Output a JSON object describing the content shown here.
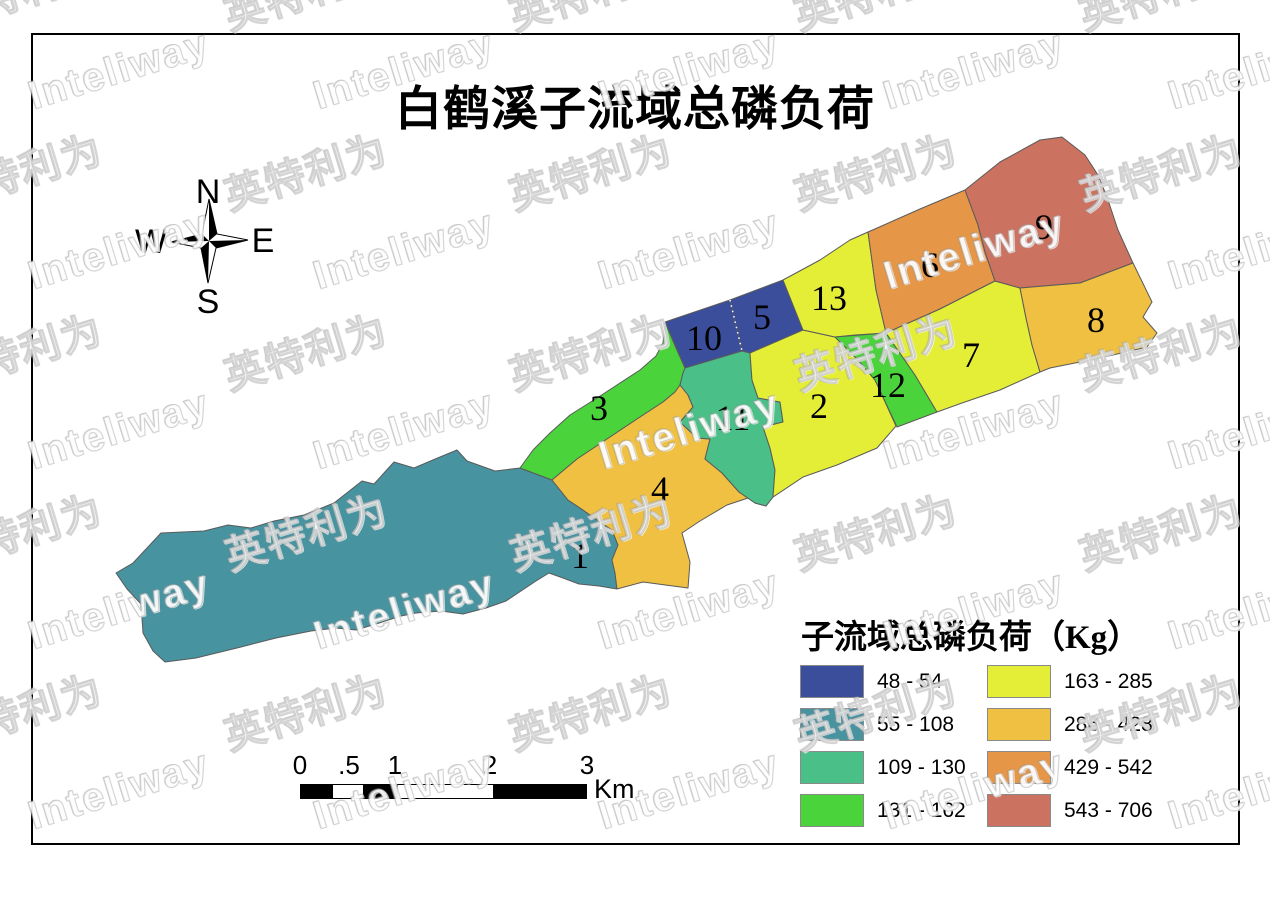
{
  "title": "白鹤溪子流域总磷负荷",
  "compass": {
    "n": "N",
    "e": "E",
    "s": "S",
    "w": "W"
  },
  "scalebar": {
    "ticks": [
      "0",
      ".5",
      "1",
      "2",
      "3"
    ],
    "unit": "Km"
  },
  "legend": {
    "title": "子流域总磷负荷（Kg）",
    "items": [
      {
        "range": "48 - 54",
        "color": "#3b4e9c"
      },
      {
        "range": "55 - 108",
        "color": "#4793a0"
      },
      {
        "range": "109 - 130",
        "color": "#4abf88"
      },
      {
        "range": "131 - 162",
        "color": "#4ad33b"
      },
      {
        "range": "163 - 285",
        "color": "#e4ee37"
      },
      {
        "range": "286 - 428",
        "color": "#efc042"
      },
      {
        "range": "429 - 542",
        "color": "#e59647"
      },
      {
        "range": "543 - 706",
        "color": "#cb7260"
      }
    ]
  },
  "watermark": {
    "latin": "Inteliway",
    "cjk": "英特利为"
  },
  "map": {
    "subbasins": [
      {
        "id": "1",
        "range": "55 - 108",
        "color": "#4793a0",
        "label": [
          580,
          556
        ],
        "points": "457,450 440,457 414,468 394,462 374,484 362,481 334,503 304,515 274,521 251,528 228,525 204,531 161,533 133,563 116,573 127,589 141,604 143,633 153,651 165,662 196,658 241,647 276,638 311,631 336,628 356,630 376,624 401,616 416,613 441,611 463,614 486,608 506,601 521,591 536,581 549,573 563,578 579,584 599,586 617,589 615,573 612,560 618,545 612,530 600,522 583,510 568,500 552,480 520,468 495,471 467,461"
      },
      {
        "id": "3",
        "range": "131 - 162",
        "color": "#4ad33b",
        "label": [
          599,
          408
        ],
        "points": "520,468 533,450 550,433 570,415 597,398 620,383 640,370 656,356 663,343 665,322 676,348 685,368 683,373 680,385 675,392 663,402 637,419 607,439 577,459 552,480"
      },
      {
        "id": "4",
        "range": "286 - 428",
        "color": "#efc042",
        "label": [
          660,
          489
        ],
        "points": "552,480 577,459 607,439 637,419 663,402 675,392 680,385 688,395 693,407 680,422 697,438 710,439 705,459 722,473 739,492 755,503 766,506 773,497 803,477 760,494 727,505 700,521 682,533 690,562 688,588 643,582 617,589 615,573 612,560 618,545 612,530 600,522 583,510 568,500"
      },
      {
        "id": "10",
        "range": "48 - 54",
        "color": "#3b4e9c",
        "label": [
          704,
          338
        ],
        "points": "665,322 730,300 742,351 685,368"
      },
      {
        "id": "5",
        "range": "48 - 54",
        "color": "#3b4e9c",
        "label": [
          762,
          317
        ],
        "points": "730,300 783,280 793,305 803,330 750,353 742,351"
      },
      {
        "id": "11",
        "range": "109 - 130",
        "color": "#4abf88",
        "label": [
          733,
          418
        ],
        "points": "680,385 683,373 685,368 742,351 750,353 752,380 758,398 780,402 783,422 763,427 770,448 775,470 773,497 766,506 755,503 739,492 722,473 705,459 710,439 697,438 680,422 693,407 688,395"
      },
      {
        "id": "2",
        "range": "163 - 285",
        "color": "#e4ee37",
        "label": [
          819,
          406
        ],
        "points": "750,353 803,330 835,337 858,360 875,380 896,426 877,448 837,465 803,477 773,497 775,470 770,448 763,427 783,422 780,402 758,398 752,380"
      },
      {
        "id": "13",
        "range": "163 - 285",
        "color": "#e4ee37",
        "label": [
          829,
          298
        ],
        "points": "783,280 820,260 850,240 868,232 876,290 886,333 855,335 835,337 803,330 793,305"
      },
      {
        "id": "12",
        "range": "131 - 162",
        "color": "#4ad33b",
        "label": [
          888,
          385
        ],
        "points": "835,337 886,333 915,375 937,412 897,427 875,380 858,360"
      },
      {
        "id": "6",
        "range": "429 - 542",
        "color": "#e59647",
        "label": [
          930,
          265
        ],
        "points": "868,232 920,209 965,190 978,225 985,252 995,281 940,309 886,333 876,290"
      },
      {
        "id": "7",
        "range": "163 - 285",
        "color": "#e4ee37",
        "label": [
          971,
          355
        ],
        "points": "886,333 940,309 995,281 1020,288 1026,318 1032,345 1040,372 1000,390 962,403 937,412 915,375"
      },
      {
        "id": "9",
        "range": "543 - 706",
        "color": "#cb7260",
        "label": [
          1044,
          227
        ],
        "points": "965,190 1000,162 1040,140 1062,137 1085,155 1098,175 1107,197 1118,230 1133,263 1080,283 1020,288 995,281 985,252 978,225"
      },
      {
        "id": "8",
        "range": "286 - 428",
        "color": "#efc042",
        "label": [
          1096,
          320
        ],
        "points": "1020,288 1080,283 1133,263 1152,302 1143,317 1157,333 1147,347 1100,358 1050,368 1040,372 1032,345 1026,318"
      }
    ]
  }
}
